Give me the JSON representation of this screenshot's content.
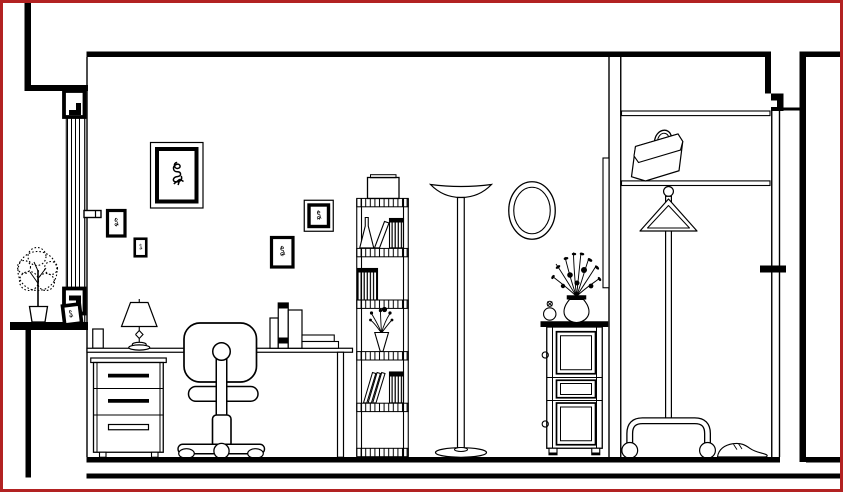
{
  "meta": {
    "type": "cad-interior-elevation-drawing",
    "description": "Black-and-white CAD line drawing: sectional elevation of a study room with window at left, desk area, bookshelf, floor lamp, mirror, dresser and a closet with door at right"
  },
  "colors": {
    "background": "#ffffff",
    "line": "#000000",
    "border": "#b22222"
  },
  "objects": {
    "architecture": [
      "left exterior wall",
      "window with glazing, head, sill blocks and ledge",
      "window crank handle",
      "ceiling",
      "floor",
      "ground line",
      "partition wall with hung panel",
      "closet shelves",
      "door leaf with handle and head frame",
      "right exterior wall"
    ],
    "furniture": [
      "desk",
      "three-drawer pedestal",
      "office swivel chair",
      "tall bookshelf",
      "dresser cabinet",
      "rolling coat stand"
    ],
    "decor": [
      "potted tree on sill ledge",
      "photo frame on sill",
      "large wall picture",
      "small wall picture 1",
      "small wall picture 2",
      "small wall picture 3",
      "small wall picture 4",
      "desk lamp",
      "books on desk",
      "binder on top of shelf",
      "laboratory flask",
      "shelf books",
      "shelf vase with flowers",
      "torchiere floor lamp",
      "oval wall mirror",
      "vase of flowers on dresser",
      "perfume bottle",
      "briefcase bag",
      "clothes hanger",
      "shoe"
    ]
  }
}
